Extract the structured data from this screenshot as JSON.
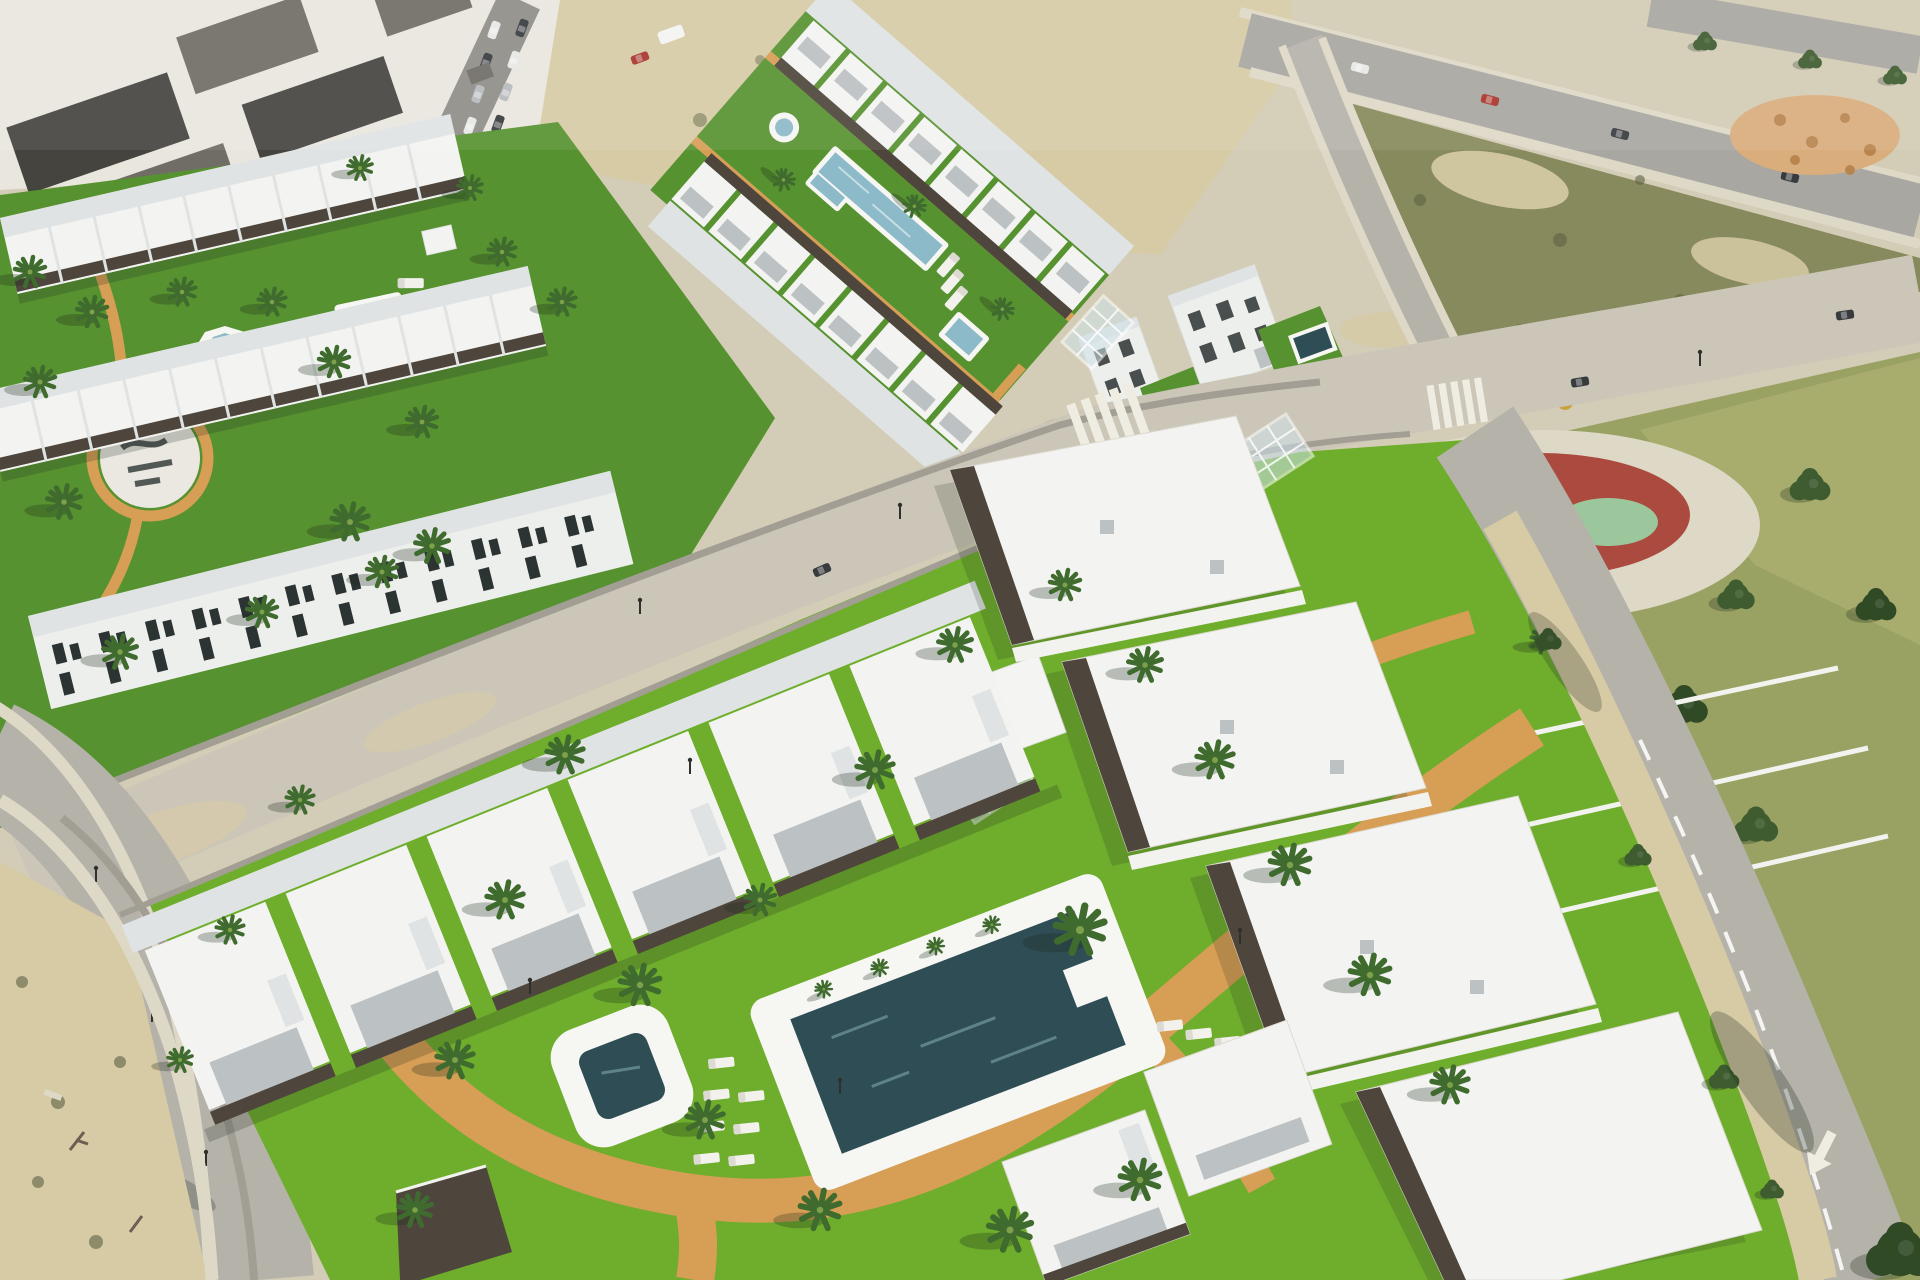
{
  "meta": {
    "title": "Aerial 3D render of a new-build white residential complex beside an existing town, with lawns, pools, palm trees, vacant lots and a tree-filled park",
    "type": "architectural-visualization-aerial-view"
  },
  "palette": {
    "baseSand": "#d3ccb6",
    "townWhite": "#e9e6de",
    "townRoofDark": "#45443f",
    "townRoofMid": "#706d66",
    "streetGrey": "#8f8e88",
    "sidewalk": "#ded8c6",
    "dirtSand": "#d7cba6",
    "oliveLot": "#878a5c",
    "oliveDark": "#5e6243",
    "duneOrange": "#d9ad7c",
    "duneDot": "#b9854f",
    "roadLight": "#b5b2aa",
    "roadPale": "#cbc6b8",
    "roadR3": "#a8a7a1",
    "wallGrey": "#a29e94",
    "wallWhite": "#f2f2ee",
    "lawnBright": "#6fae2c",
    "lawnMid": "#579230",
    "parkGrass": "#99a263",
    "parkGrassLight": "#aaad6e",
    "playRed": "#ab4a3e",
    "playGreen": "#9cc79c",
    "pathOrange": "#d79e55",
    "poolLight": "#8cbac9",
    "poolDark": "#2f4d55",
    "poolRim": "#f6f6f3",
    "roofWhite": "#f3f4f1",
    "roofLight": "#dfe3e3",
    "facadeWhite": "#edefec",
    "terraceGrey": "#bcc1c3",
    "pergola": "#4e463c",
    "windowDark": "#2c3333",
    "glass": "#cfe2ea",
    "palmDark": "#3f6b2e",
    "palmLight": "#7da04b",
    "parkTree": "#3e5c2f",
    "parkTreeDark": "#2f4a25",
    "loungerWhite": "#f2f1ec",
    "stripeWhite": "#efece2",
    "carRed": "#a8352c",
    "carDark": "#383b3e",
    "carWhite": "#e8e8e5",
    "carSilver": "#b7babc",
    "shadowCol": "#1e2a1e"
  },
  "scene": {
    "districts": [
      "existing town block with dark grey roofs and a street of parked cars (top left)",
      "sandy vacant strip with a red car and white van (top centre)",
      "two-row townhouse complex with lawn, octagonal fountain, square pool and circular logo plaza (upper left)",
      "townhouse complex around a long green courtyard with lap pool, round fountain and small square pool (upper centre)",
      "pair of detached white villas with private pools (centre right)",
      "olive scrub vacant lot with sandy mounds and perimeter roads (top right)",
      "public park with dense pine trees and a red circular playground (right)",
      "large new apartment complex with bright lawn, main pool, plunge pool, palm trees and orange paths (bottom)",
      "roads with crosswalks, street lamps, lane arrow and tree shadows (left, centre, bottom right)"
    ],
    "water_features": [
      "long lap pool",
      "round fountain",
      "small square pool",
      "octagonal fountain",
      "rectangular pool with deck",
      "main community pool with sun loungers",
      "rounded-square plunge pool",
      "two villa pools"
    ],
    "vehicles": "parked cars in town street, red car and white van on sand, cars on perimeter roads",
    "road_markings": [
      "zebra crosswalks",
      "dashed lane line",
      "white direction arrow"
    ],
    "ground_logo": "illegible dark logo painted on circular white plaza"
  }
}
